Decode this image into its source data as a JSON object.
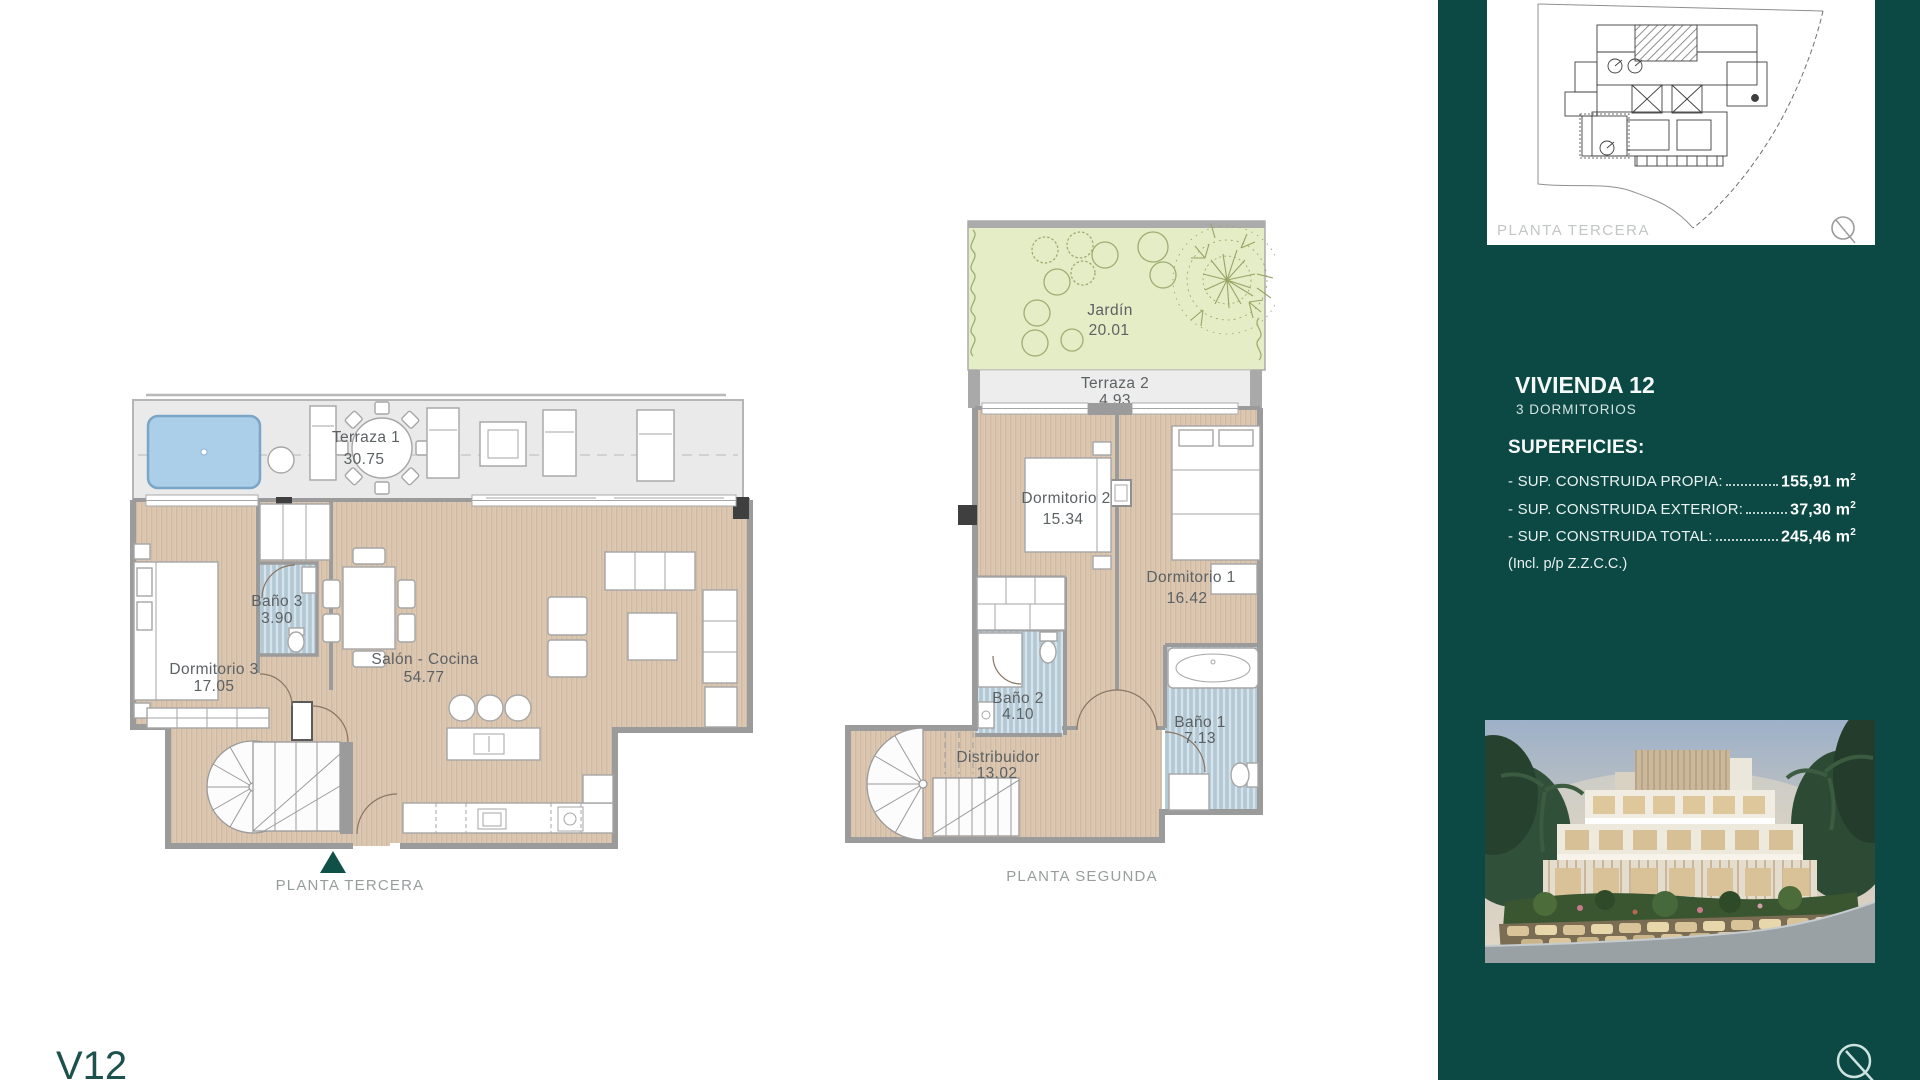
{
  "page": {
    "watermark": "V12"
  },
  "colors": {
    "sidebar_background": "#0c4945",
    "accent_triangle": "#0f5147",
    "wood_floor": "#ddc9b4",
    "bath_floor": "#b9cdd9",
    "garden": "#e5edc6",
    "terrace": "#eaeaea",
    "pool": "#abcfe9"
  },
  "plans": {
    "tercera": {
      "caption": "PLANTA TERCERA",
      "rooms": {
        "terraza": {
          "name": "Terraza 1",
          "area": "30.75"
        },
        "dormitorio3": {
          "name": "Dormitorio 3",
          "area": "17.05"
        },
        "bano3": {
          "name": "Baño 3",
          "area": "3.90"
        },
        "salon": {
          "name": "Salón - Cocina",
          "area": "54.77"
        }
      }
    },
    "segunda": {
      "caption": "PLANTA SEGUNDA",
      "rooms": {
        "jardin": {
          "name": "Jardín",
          "area": "20.01"
        },
        "terraza2": {
          "name": "Terraza 2",
          "area": "4.93"
        },
        "dormitorio2": {
          "name": "Dormitorio 2",
          "area": "15.34"
        },
        "dormitorio1": {
          "name": "Dormitorio 1",
          "area": "16.42"
        },
        "bano2": {
          "name": "Baño 2",
          "area": "4.10"
        },
        "bano1": {
          "name": "Baño 1",
          "area": "7.13"
        },
        "distribuidor": {
          "name": "Distribuidor",
          "area": "13.02"
        }
      }
    }
  },
  "sidebar": {
    "siteplan": {
      "label": "PLANTA TERCERA"
    },
    "unit": {
      "title": "VIVIENDA 12",
      "subtitle": "3 DORMITORIOS"
    },
    "superficies": {
      "heading": "SUPERFICIES:",
      "rows": [
        {
          "label": "- SUP. CONSTRUIDA PROPIA:",
          "value": "155,91",
          "unit": "m",
          "exp": "2"
        },
        {
          "label": "- SUP. CONSTRUIDA EXTERIOR:",
          "value": "37,30",
          "unit": "m",
          "exp": "2"
        },
        {
          "label": "- SUP. CONSTRUIDA TOTAL:",
          "value": "245,46",
          "unit": "m",
          "exp": "2"
        }
      ],
      "note": "(Incl. p/p Z.Z.C.C.)"
    }
  }
}
